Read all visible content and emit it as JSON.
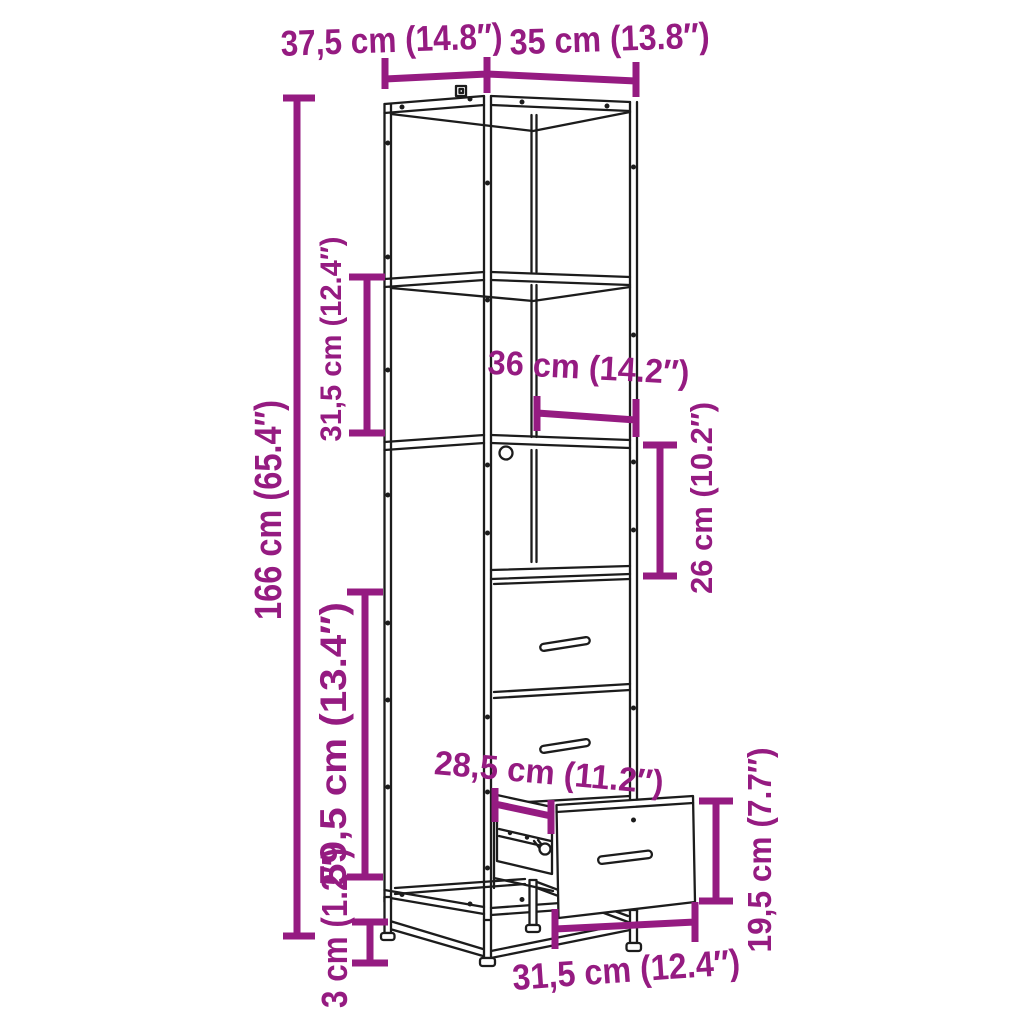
{
  "diagram": {
    "kind": "furniture dimension diagram",
    "subject": "tall cabinet with open shelves, compartment and drawers, bottom drawer pulled open",
    "background": "#ffffff",
    "line_color": "#1c1c1c",
    "dimension_color": "#951b81"
  },
  "dimensions": {
    "top_depth": "37,5 cm (14.8″)",
    "top_width": "35 cm (13.8″)",
    "total_height": "166 cm (65.4″)",
    "upper_shelf_height": "31,5 cm (12.4″)",
    "inner_width": "36 cm (14.2″)",
    "compartment_height": "26 cm (10.2″)",
    "lower_section_height": "59,5 cm (13.4″)",
    "leg_height": "3 cm (1.2″)",
    "drawer_depth": "28,5 cm (11.2″)",
    "drawer_front_height": "19,5 cm (7.7″)",
    "drawer_width": "31,5 cm (12.4″)"
  }
}
